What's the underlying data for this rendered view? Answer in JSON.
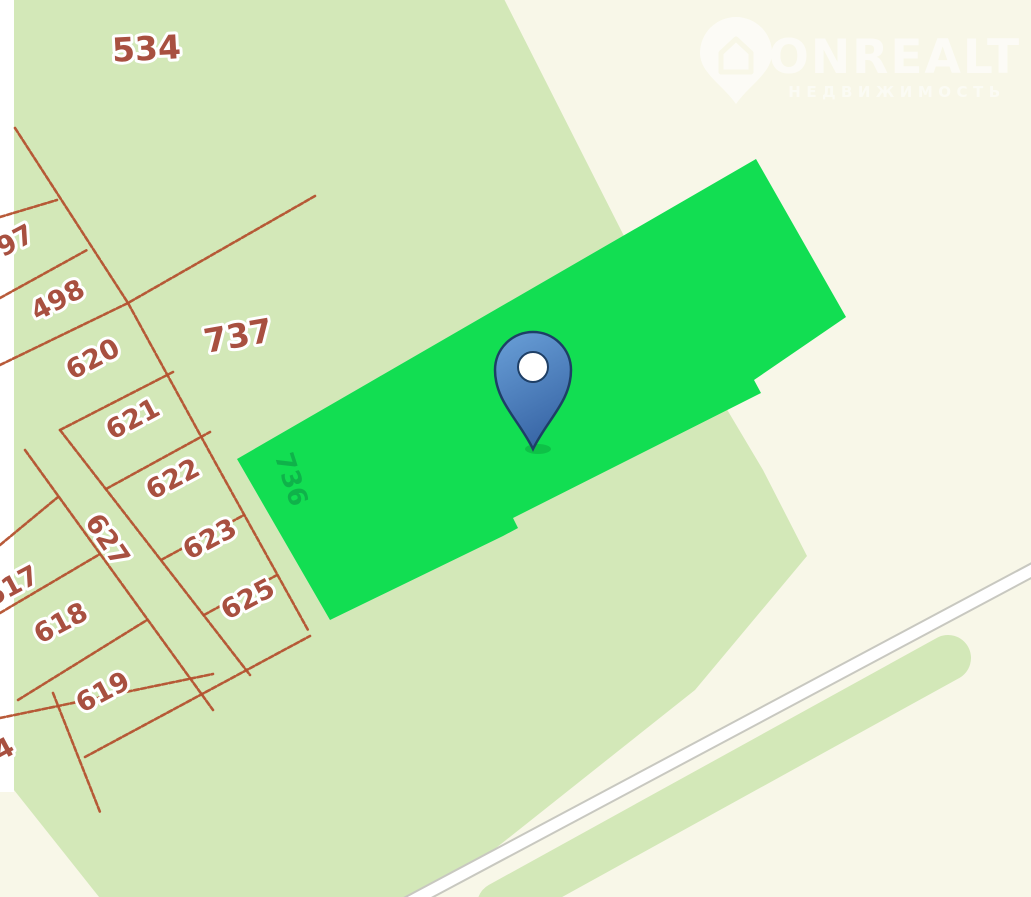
{
  "colors": {
    "bg_beige": "#f8f7e8",
    "tile_white": "#ffffff",
    "field_green": "#d3e8b8",
    "parcel_green": "#12de52",
    "parcel_green_label": "#0fa448",
    "line_red": "#b4512e",
    "label_red": "#a85040",
    "road_casing": "#c8c8c0",
    "road_fill": "#ffffff",
    "pin_fill_top": "#6aa0d8",
    "pin_fill_bottom": "#3a68a8",
    "pin_outline": "#1e3f66",
    "watermark_white": "#ffffff"
  },
  "watermark": {
    "brand": "ONREALT",
    "subtitle": "НЕДВИЖИМОСТЬ"
  },
  "map": {
    "field_polygon": "14,-5 502,-5 625,238 763,470 807,556 695,690 428,902 103,902 14,790",
    "tile_strip": {
      "x": 0,
      "y": 0,
      "w": 14,
      "h": 792
    },
    "highlight_parcel": {
      "label": "736",
      "points": "237,459 756,159 846,317 754,380 761,393 513,518 518,528 503,536 330,620"
    },
    "road": {
      "x1": 395,
      "y1": 910,
      "x2": 1040,
      "y2": 566
    },
    "green_strip": {
      "x1": 500,
      "y1": 905,
      "x2": 948,
      "y2": 658
    },
    "marker": {
      "x": 533,
      "y": 447
    },
    "parcel_labels": [
      {
        "text": "534",
        "x": 147,
        "y": 60,
        "rot": -3,
        "size": 33
      },
      {
        "text": "497",
        "x": 11,
        "y": 253,
        "rot": -28,
        "size": 27
      },
      {
        "text": "498",
        "x": 62,
        "y": 308,
        "rot": -28,
        "size": 27
      },
      {
        "text": "620",
        "x": 97,
        "y": 367,
        "rot": -28,
        "size": 27
      },
      {
        "text": "621",
        "x": 137,
        "y": 427,
        "rot": -28,
        "size": 27
      },
      {
        "text": "622",
        "x": 177,
        "y": 487,
        "rot": -28,
        "size": 27
      },
      {
        "text": "623",
        "x": 214,
        "y": 547,
        "rot": -28,
        "size": 27
      },
      {
        "text": "625",
        "x": 252,
        "y": 607,
        "rot": -28,
        "size": 27
      },
      {
        "text": "627",
        "x": 100,
        "y": 545,
        "rot": 56,
        "size": 27
      },
      {
        "text": "617",
        "x": 16,
        "y": 594,
        "rot": -28,
        "size": 27
      },
      {
        "text": "618",
        "x": 65,
        "y": 631,
        "rot": -28,
        "size": 27
      },
      {
        "text": "619",
        "x": 107,
        "y": 700,
        "rot": -28,
        "size": 27
      },
      {
        "text": "4",
        "x": 8,
        "y": 757,
        "rot": -28,
        "size": 27
      },
      {
        "text": "737",
        "x": 240,
        "y": 347,
        "rot": -10,
        "size": 33
      },
      {
        "text": "736",
        "x": 283,
        "y": 482,
        "rot": 72,
        "size": 26,
        "style": "on-green"
      }
    ],
    "boundary_segments": [
      {
        "points": "15,128 128,303 215,462 308,630"
      },
      {
        "points": "0,217 57,200"
      },
      {
        "points": "0,298 87,250"
      },
      {
        "points": "0,365 128,303 315,196"
      },
      {
        "points": "60,430 173,372"
      },
      {
        "points": "106,489 210,432"
      },
      {
        "points": "161,560 244,515"
      },
      {
        "points": "204,615 277,575"
      },
      {
        "points": "25,450 213,710"
      },
      {
        "points": "60,430 250,675"
      },
      {
        "points": "0,545 58,497"
      },
      {
        "points": "0,613 100,554"
      },
      {
        "points": "18,700 147,620"
      },
      {
        "points": "0,718 213,674"
      },
      {
        "points": "85,757 310,636"
      },
      {
        "points": "53,693 100,812"
      }
    ]
  }
}
